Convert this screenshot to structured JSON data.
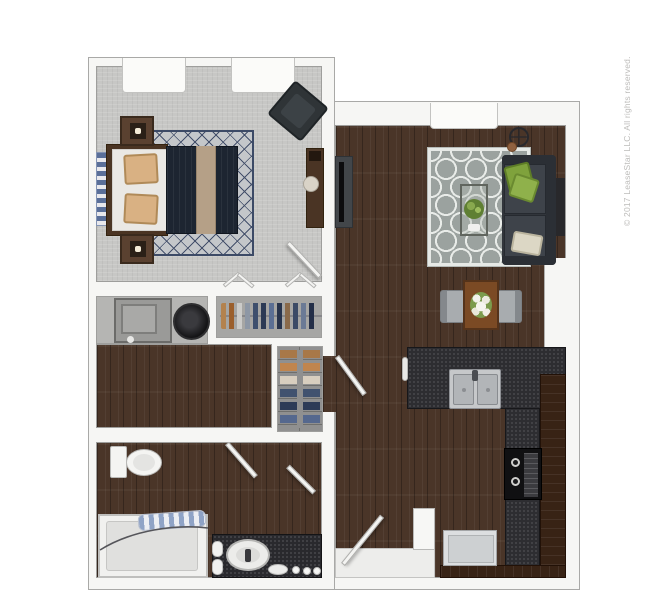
{
  "watermark": {
    "text": "© 2017 LeaseStar LLC. All rights reserved."
  },
  "palette": {
    "background": "#ffffff",
    "wall_fill": "#f6f6f4",
    "wall_outline": "#a9a9a7",
    "carpet": "#c7c7c5",
    "wood_floor": "#4a3528",
    "counter_granite": "#2d2d31",
    "cabinet_wood": "#382315",
    "living_rug_gray": "#9ba29f",
    "living_rug_pattern": "#e9ece9",
    "bedroom_rug_line": "#3c4a66",
    "sofa_charcoal": "#31353b",
    "pillow_green": "#7fa23c",
    "pillow_tan": "#d9b183",
    "bed_duvet_navy": "#1d2531",
    "bed_throw_tan": "#b5a087",
    "dining_table_wood": "#7b4a24",
    "appliance_gray": "#9a9a98",
    "dryer_black": "#131315"
  }
}
